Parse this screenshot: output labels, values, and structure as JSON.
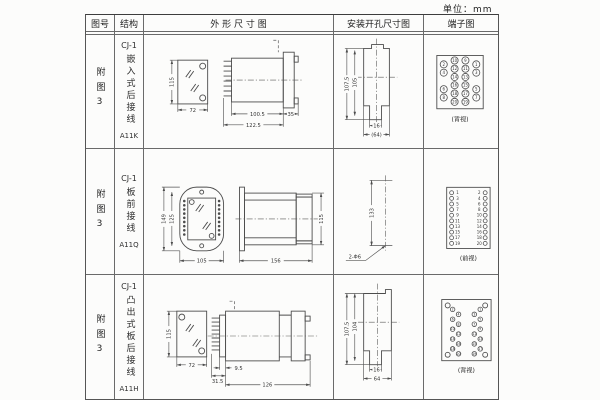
{
  "unit_label": "单位：mm",
  "headers": {
    "fig_no": "图号",
    "structure": "结构",
    "outline": "外 形 尺 寸 图",
    "install": "安装开孔尺寸图",
    "terminal": "端子图"
  },
  "rows": [
    {
      "fig_no": "附图3",
      "structure_prefix": "CJ-1",
      "structure_text": "嵌入式后接线",
      "model": "A11K",
      "outline": {
        "h": "115",
        "w": "72",
        "d1": "100.5",
        "d2": "122.5",
        "d3": "35"
      },
      "install": {
        "v1": "107.5",
        "v2": "105",
        "h1": "16",
        "h2": "(64)"
      },
      "terminal": {
        "caption": "(背视)",
        "outer_left": [
          "2",
          "4",
          "6",
          "8"
        ],
        "inner_left": [
          "10",
          "12",
          "14",
          "16",
          "18",
          "20"
        ],
        "inner_right": [
          "9",
          "11",
          "13",
          "15",
          "17",
          "19"
        ],
        "outer_right": [
          "1",
          "3",
          "5",
          "7"
        ]
      }
    },
    {
      "fig_no": "附图3",
      "structure_prefix": "CJ-1",
      "structure_text": "板前接线",
      "model": "A11Q",
      "outline": {
        "h1": "149",
        "h2": "125",
        "w": "105",
        "d1": "156",
        "d2": "115"
      },
      "install": {
        "v1": "133",
        "hole_label": "2-Φ6"
      },
      "terminal": {
        "caption": "(前视)",
        "left": [
          "1",
          "3",
          "5",
          "7",
          "9",
          "11",
          "13",
          "15",
          "17",
          "19"
        ],
        "right": [
          "2",
          "4",
          "6",
          "8",
          "10",
          "12",
          "14",
          "16",
          "18",
          "20"
        ]
      }
    },
    {
      "fig_no": "附图3",
      "structure_prefix": "CJ-1",
      "structure_text": "凸出式板后接线",
      "model": "A11H",
      "outline": {
        "h": "115",
        "w": "72",
        "d1": "9.5",
        "d2": "31.5",
        "d3": "126"
      },
      "install": {
        "v1": "107.5",
        "v2": "104",
        "h1": "16",
        "h2": "64"
      },
      "terminal": {
        "caption": "(背视)",
        "left": [
          "2",
          "4",
          "6",
          "8",
          "10",
          "12",
          "14",
          "16",
          "18",
          "20"
        ],
        "right": [
          "1",
          "3",
          "5",
          "7",
          "9",
          "11",
          "13",
          "15",
          "17",
          "19"
        ]
      }
    }
  ]
}
